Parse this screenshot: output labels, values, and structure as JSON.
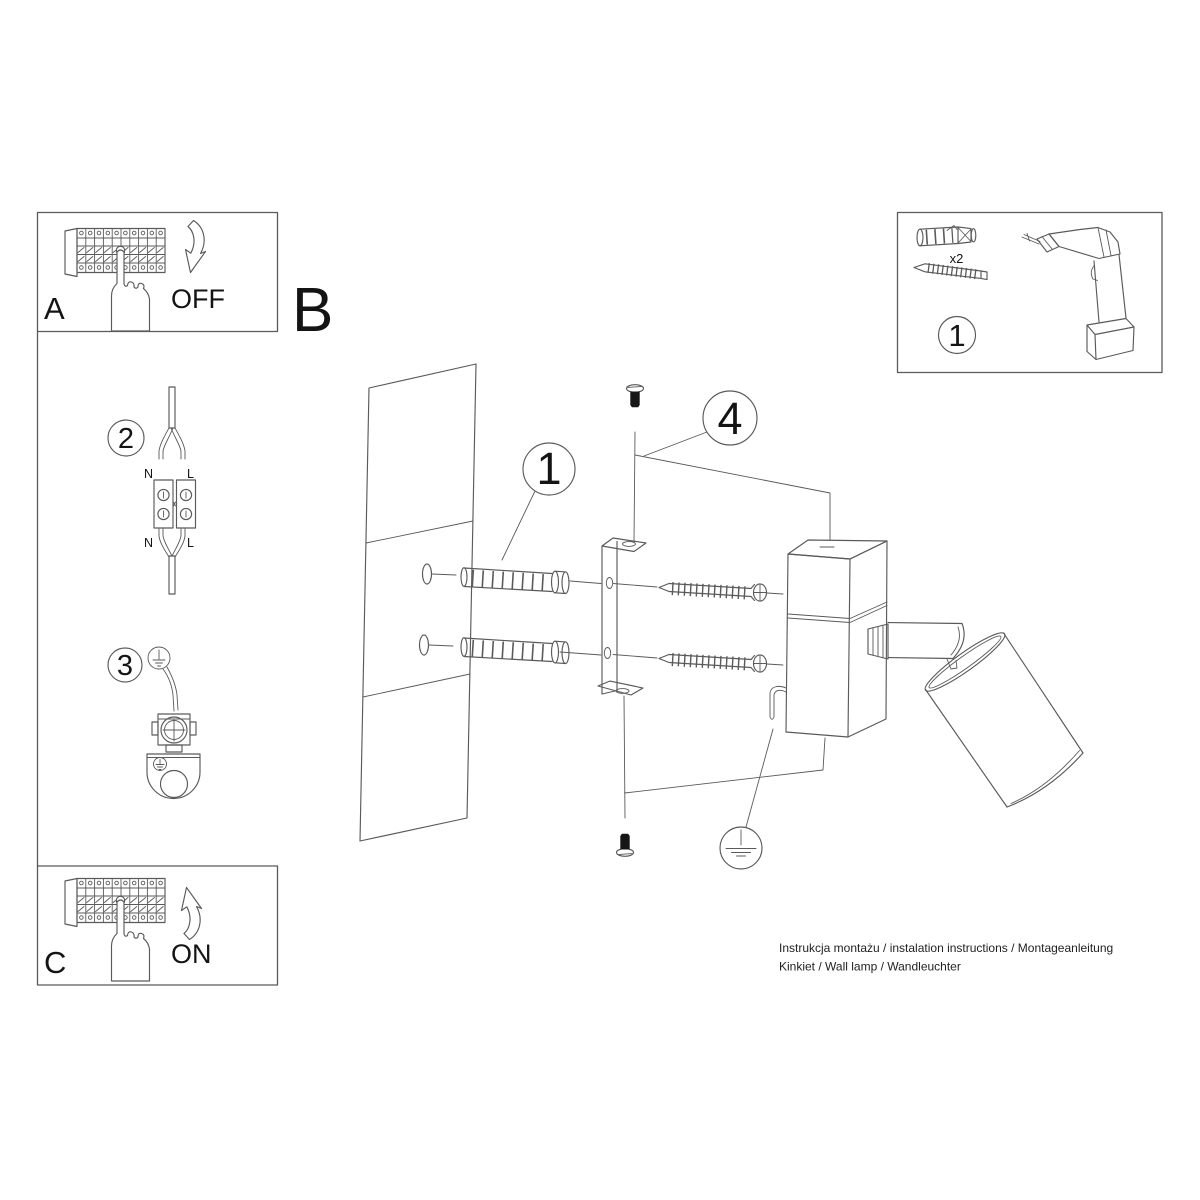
{
  "colors": {
    "background": "#ffffff",
    "line": "#5a5a5a",
    "ink": "#141414"
  },
  "panels": {
    "a": {
      "label": "A",
      "action": "OFF"
    },
    "b": {
      "label": "B"
    },
    "c": {
      "label": "C",
      "action": "ON"
    },
    "kit": {
      "number": "1",
      "anchor_qty": "x2"
    }
  },
  "steps": {
    "wiring": {
      "number": "2",
      "top_left": "N",
      "top_right": "L",
      "bottom_left": "N",
      "bottom_right": "L"
    },
    "ground": {
      "number": "3"
    },
    "anchors": {
      "number": "1"
    },
    "mounting": {
      "number": "4"
    }
  },
  "footer": {
    "line1": "Instrukcja montażu / instalation instructions / Montageanleitung",
    "line2": "Kinkiet / Wall lamp / Wandleuchter"
  }
}
